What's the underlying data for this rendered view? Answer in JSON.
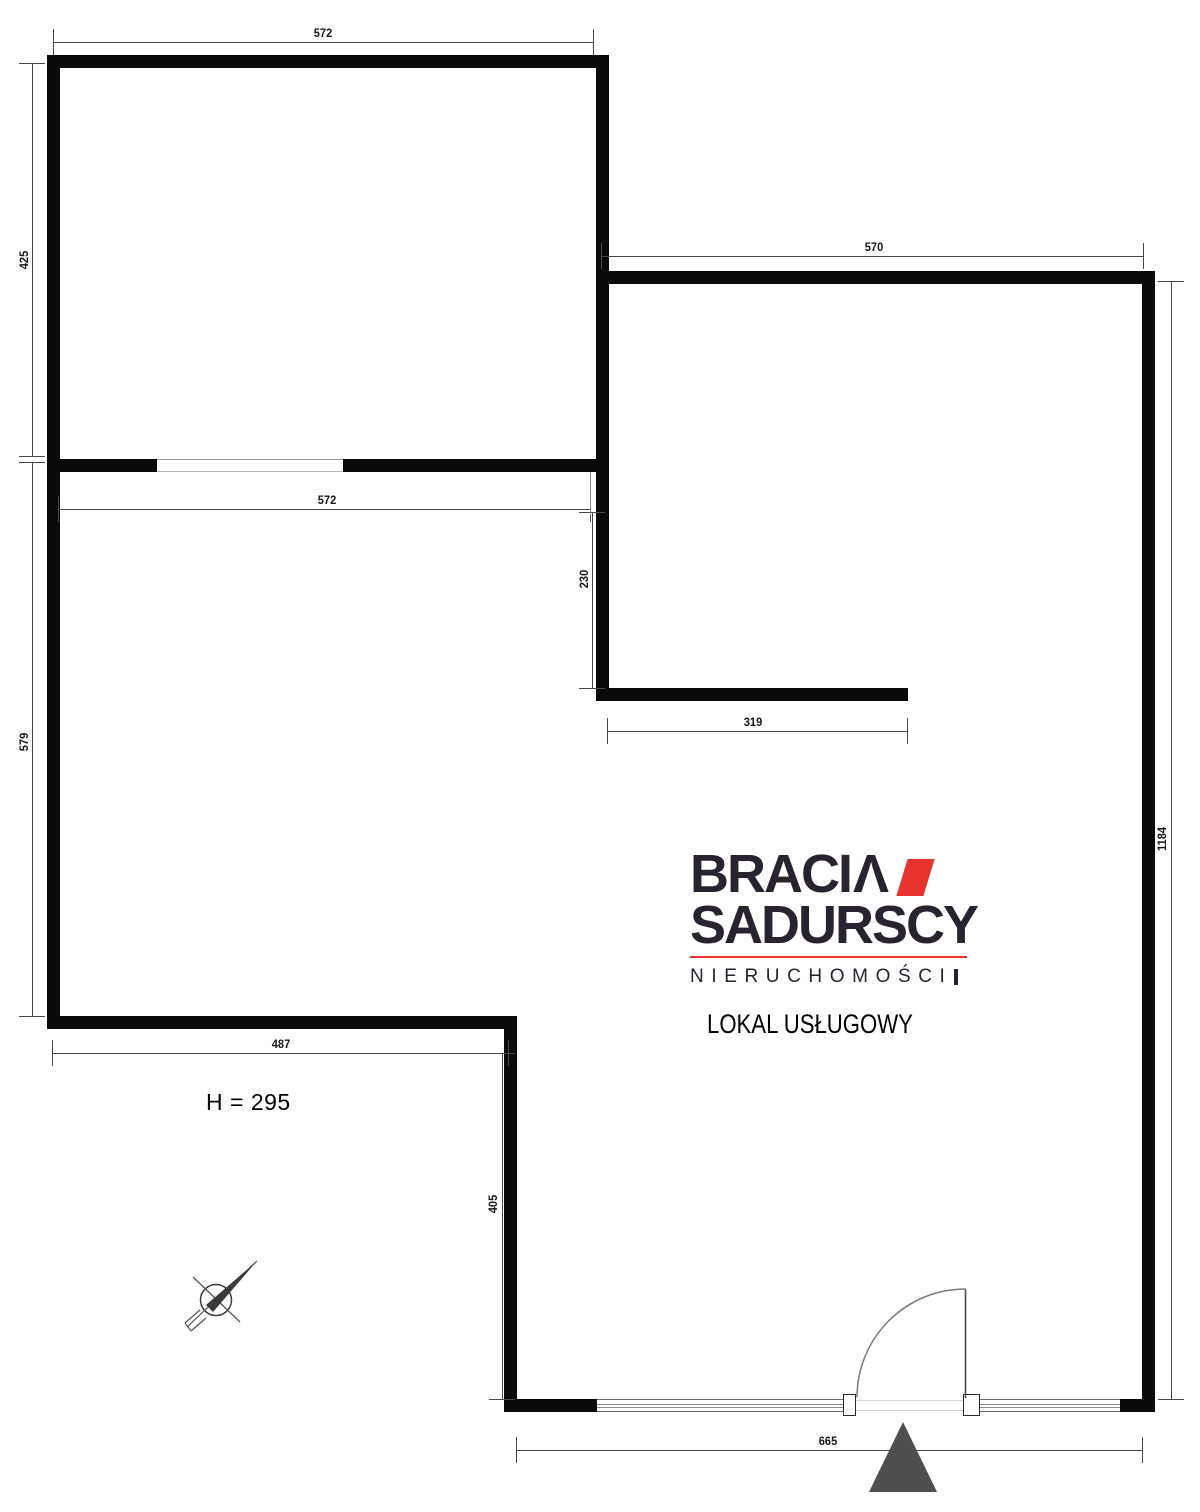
{
  "meta": {
    "width": 1200,
    "height": 1512,
    "background": "#ffffff"
  },
  "colors": {
    "wall": "#0b0b0b",
    "dim_line": "#4a4a4a",
    "dim_text": "#161616",
    "logo_dark": "#29232f",
    "logo_red": "#e8322e",
    "triangle": "#4f4f4f",
    "door_stroke": "#777777",
    "window_line": "#8d8d8d"
  },
  "logo": {
    "brand_top": "BRACI",
    "brand_caret": "Λ",
    "brand_bottom": "SADURSCY",
    "tagline": "NIERUCHOMOŚCI",
    "listing_type": "LOKAL USŁUGOWY"
  },
  "plan": {
    "height_note": "H = 295",
    "walls": [
      {
        "x": 47,
        "y": 55,
        "w": 561,
        "h": 13
      },
      {
        "x": 47,
        "y": 55,
        "w": 13,
        "h": 974
      },
      {
        "x": 60,
        "y": 459,
        "w": 97,
        "h": 13
      },
      {
        "x": 343,
        "y": 459,
        "w": 253,
        "h": 13
      },
      {
        "x": 596,
        "y": 55,
        "w": 13,
        "h": 646
      },
      {
        "x": 609,
        "y": 271,
        "w": 546,
        "h": 13
      },
      {
        "x": 1142,
        "y": 271,
        "w": 13,
        "h": 1141
      },
      {
        "x": 596,
        "y": 688,
        "w": 312,
        "h": 13
      },
      {
        "x": 47,
        "y": 1016,
        "w": 470,
        "h": 13
      },
      {
        "x": 504,
        "y": 1029,
        "w": 13,
        "h": 383
      },
      {
        "x": 517,
        "y": 1399,
        "w": 80,
        "h": 13
      },
      {
        "x": 1120,
        "y": 1399,
        "w": 22,
        "h": 13
      }
    ],
    "openings": [
      {
        "type": "passage",
        "x": 157,
        "y": 459,
        "w": 186,
        "h": 13
      },
      {
        "type": "window",
        "x": 597,
        "y": 1399,
        "w": 249,
        "h": 13
      },
      {
        "type": "window",
        "x": 980,
        "y": 1399,
        "w": 140,
        "h": 13
      },
      {
        "type": "threshold",
        "x": 856,
        "y": 1400,
        "w": 107,
        "h": 11
      },
      {
        "type": "door_post",
        "x": 843,
        "y": 1394,
        "w": 13,
        "h": 22
      },
      {
        "type": "door_post",
        "x": 963,
        "y": 1394,
        "w": 17,
        "h": 22
      }
    ],
    "dimensions": [
      {
        "label": "572",
        "dir": "h",
        "x1": 53,
        "x2": 593,
        "y": 42,
        "tx": 323,
        "ty": 33
      },
      {
        "label": "425",
        "dir": "v",
        "y1": 63,
        "y2": 456,
        "x": 32,
        "tx": 24,
        "ty": 260
      },
      {
        "label": "570",
        "dir": "h",
        "x1": 601,
        "x2": 1143,
        "y": 256,
        "tx": 874,
        "ty": 247
      },
      {
        "label": "572",
        "dir": "h",
        "x1": 58,
        "x2": 590,
        "y": 509,
        "tx": 327,
        "ty": 500
      },
      {
        "label": "579",
        "dir": "v",
        "y1": 462,
        "y2": 1016,
        "x": 32,
        "tx": 24,
        "ty": 742
      },
      {
        "label": "230",
        "dir": "v",
        "y1": 512,
        "y2": 688,
        "x": 592,
        "tx": 584,
        "ty": 579
      },
      {
        "label": "319",
        "dir": "h",
        "x1": 607,
        "x2": 907,
        "y": 731,
        "tx": 753,
        "ty": 722
      },
      {
        "label": "1184",
        "dir": "v",
        "y1": 281,
        "y2": 1399,
        "x": 1171,
        "tx": 1162,
        "ty": 839
      },
      {
        "label": "487",
        "dir": "h",
        "x1": 52,
        "x2": 508,
        "y": 1053,
        "tx": 281,
        "ty": 1044
      },
      {
        "label": "405",
        "dir": "v",
        "y1": 1053,
        "y2": 1399,
        "x": 502,
        "tx": 493,
        "ty": 1204
      },
      {
        "label": "665",
        "dir": "h",
        "x1": 516,
        "x2": 1142,
        "y": 1450,
        "tx": 828,
        "ty": 1441
      }
    ],
    "extensions": [
      {
        "x": 590,
        "y": 472,
        "w": 1,
        "h": 44
      }
    ]
  }
}
